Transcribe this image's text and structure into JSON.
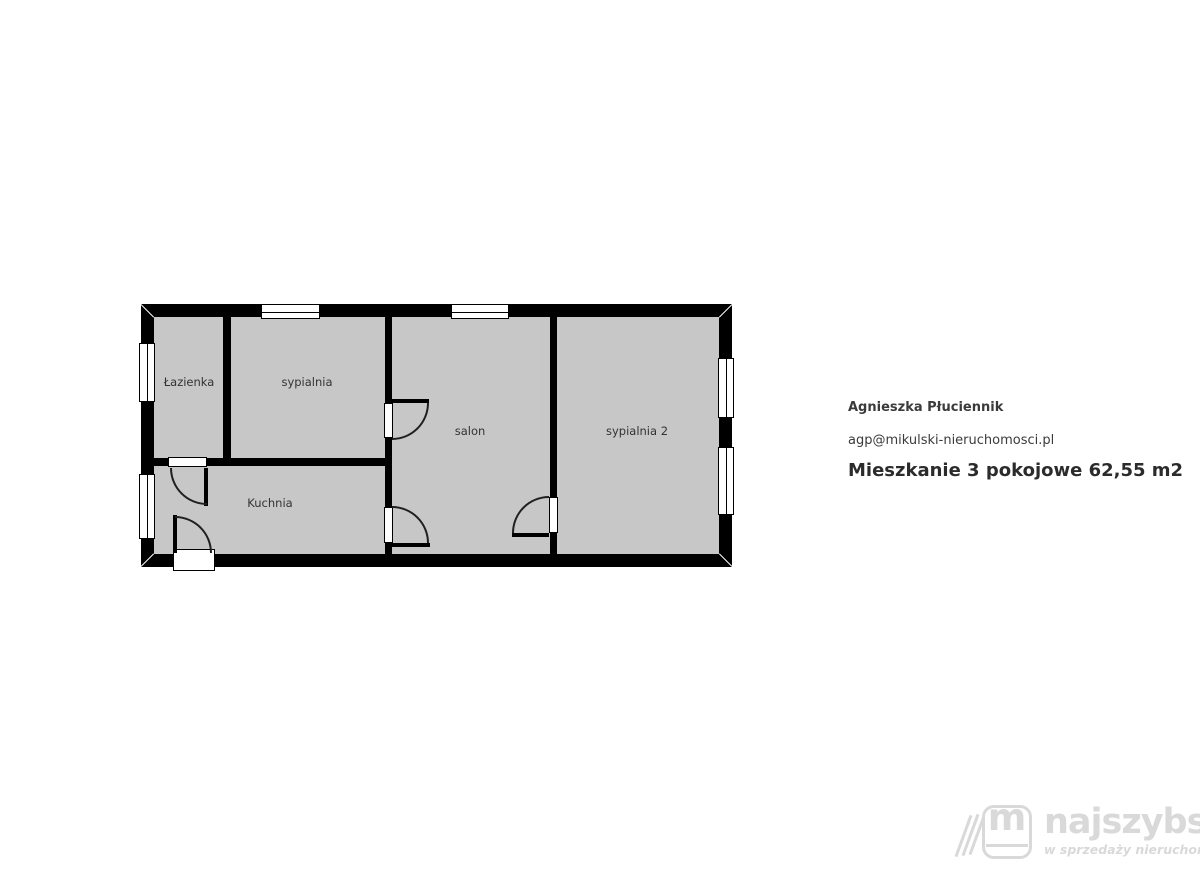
{
  "floorplan": {
    "wall_color": "#000000",
    "room_fill_color": "#c7c7c7",
    "rooms": [
      {
        "label": "Łazienka"
      },
      {
        "label": "sypialnia"
      },
      {
        "label": "salon"
      },
      {
        "label": "sypialnia 2"
      },
      {
        "label": "Kuchnia"
      }
    ]
  },
  "agent": {
    "name": "Agnieszka Płuciennik",
    "email": "agp@mikulski-nieruchomosci.pl",
    "listing_title": "Mieszkanie 3 pokojowe 62,55 m2"
  },
  "logo": {
    "brand": "najszybsi",
    "tagline": "w sprzedaży nieruchomości",
    "icon_letter": "m",
    "color": "#d9d9d9"
  }
}
